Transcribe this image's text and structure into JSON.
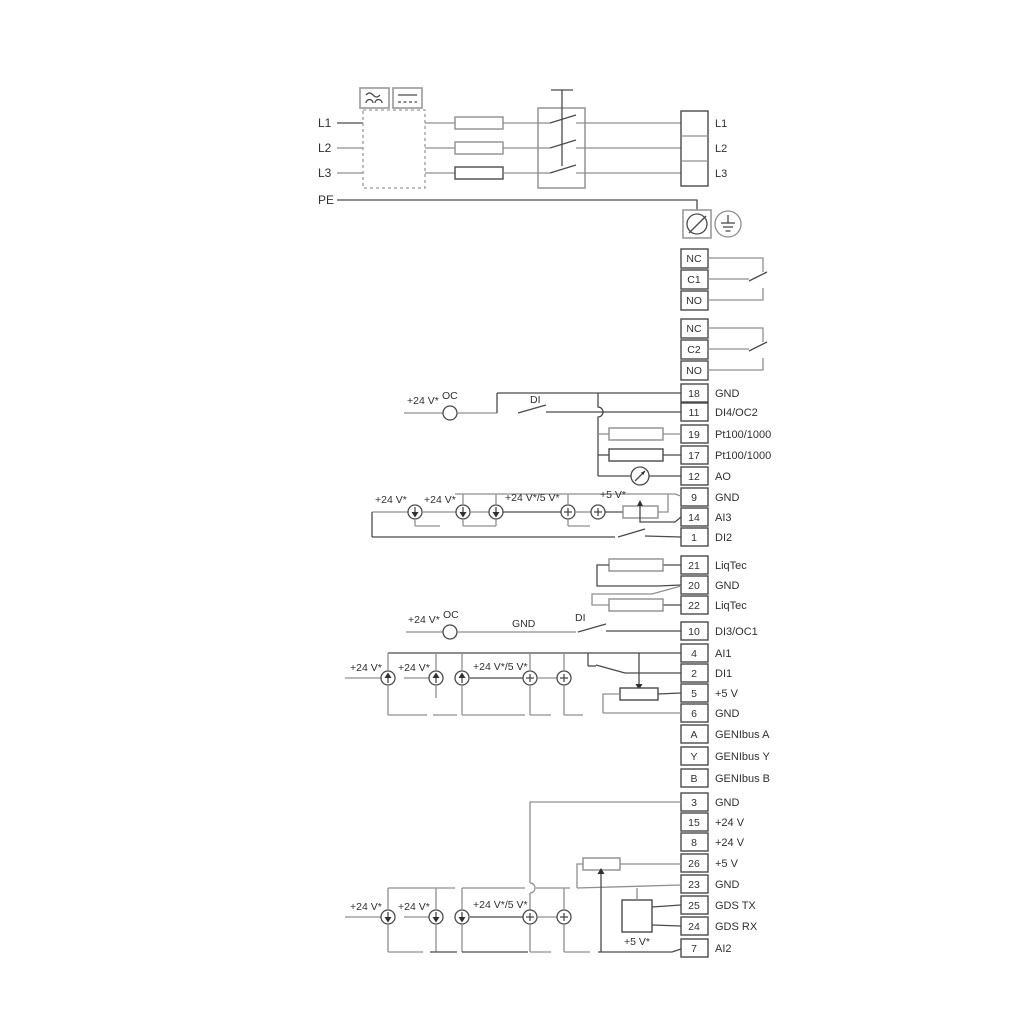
{
  "colors": {
    "wire": "#8f8f8f",
    "wire_dark": "#4a4a4a",
    "text": "#303030",
    "background": "#ffffff"
  },
  "mains": {
    "in": [
      "L1",
      "L2",
      "L3",
      "PE"
    ],
    "out": [
      "L1",
      "L2",
      "L3"
    ]
  },
  "relay1": [
    "NC",
    "C1",
    "NO"
  ],
  "relay2": [
    "NC",
    "C2",
    "NO"
  ],
  "io": {
    "a": [
      {
        "no": "18",
        "label": "GND"
      },
      {
        "no": "11",
        "label": "DI4/OC2"
      },
      {
        "no": "19",
        "label": "Pt100/1000"
      },
      {
        "no": "17",
        "label": "Pt100/1000"
      },
      {
        "no": "12",
        "label": "AO"
      },
      {
        "no": "9",
        "label": "GND"
      },
      {
        "no": "14",
        "label": "AI3"
      },
      {
        "no": "1",
        "label": "DI2"
      }
    ],
    "b": [
      {
        "no": "21",
        "label": "LiqTec"
      },
      {
        "no": "20",
        "label": "GND"
      },
      {
        "no": "22",
        "label": "LiqTec"
      }
    ],
    "c": [
      {
        "no": "10",
        "label": "DI3/OC1"
      },
      {
        "no": "4",
        "label": "AI1"
      },
      {
        "no": "2",
        "label": "DI1"
      },
      {
        "no": "5",
        "label": "+5 V"
      },
      {
        "no": "6",
        "label": "GND"
      },
      {
        "no": "A",
        "label": "GENIbus A"
      },
      {
        "no": "Y",
        "label": "GENIbus Y"
      },
      {
        "no": "B",
        "label": "GENIbus B"
      }
    ],
    "d": [
      {
        "no": "3",
        "label": "GND"
      },
      {
        "no": "15",
        "label": "+24 V"
      },
      {
        "no": "8",
        "label": "+24 V"
      },
      {
        "no": "26",
        "label": "+5 V"
      },
      {
        "no": "23",
        "label": "GND"
      },
      {
        "no": "25",
        "label": "GDS TX"
      },
      {
        "no": "24",
        "label": "GDS RX"
      },
      {
        "no": "7",
        "label": "AI2"
      }
    ]
  },
  "ann": {
    "v24": "+24 V*",
    "v24v5": "+24 V*/5 V*",
    "v5": "+5 V*",
    "oc": "OC",
    "di": "DI",
    "gnd": "GND"
  }
}
